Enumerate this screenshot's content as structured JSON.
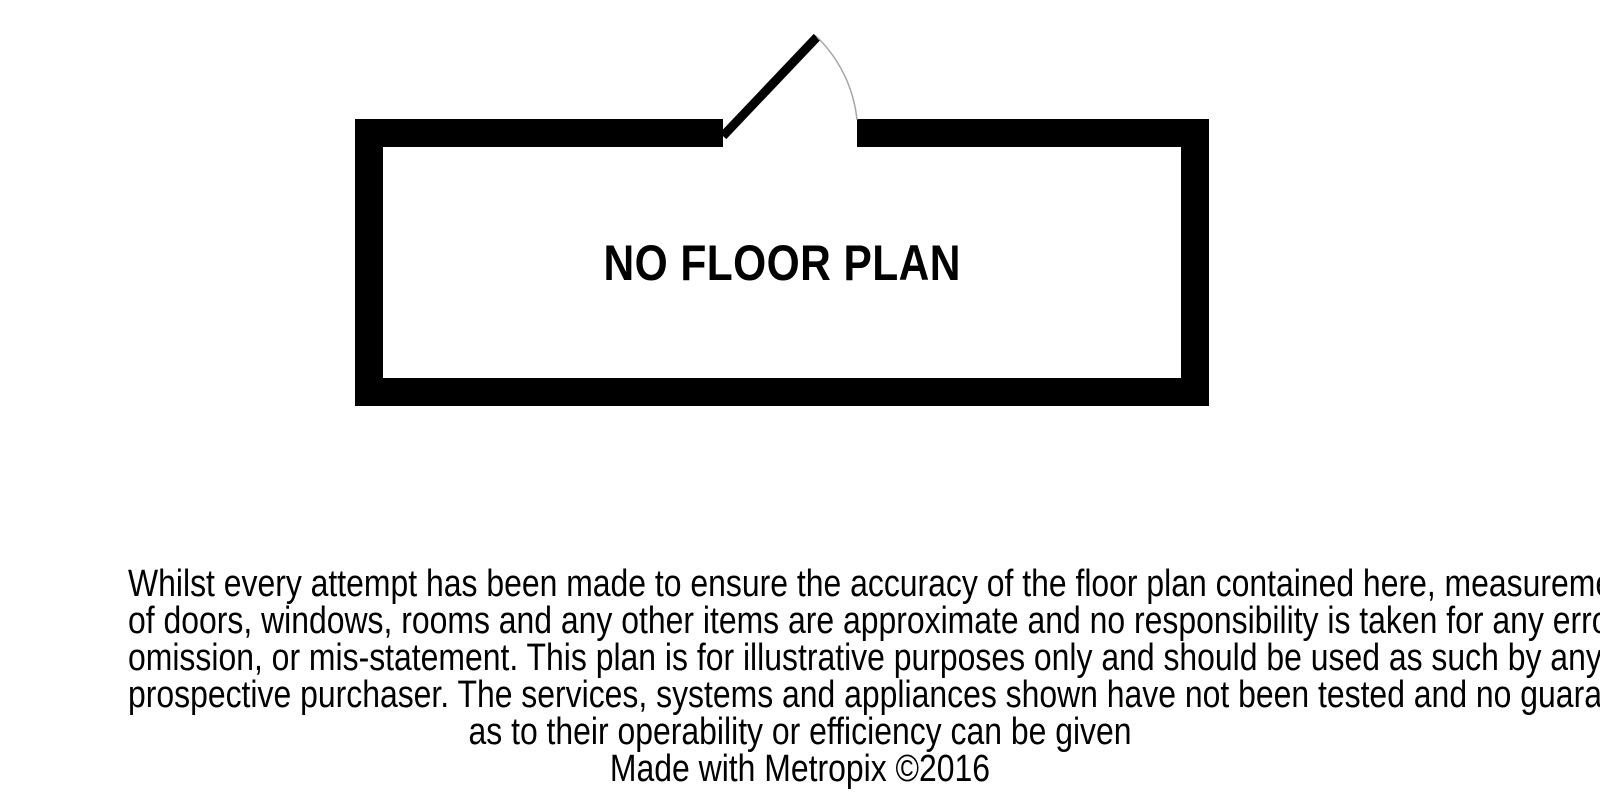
{
  "floor_plan": {
    "label": "NO FLOOR PLAN"
  },
  "disclaimer": {
    "lines": [
      "Whilst every attempt has been made to ensure the accuracy of the floor plan contained here, measurements",
      "of doors, windows, rooms and any other items are approximate and no responsibility is taken for any error,",
      "omission, or mis-statement. This plan is for illustrative purposes only and should be used as such by any",
      "prospective purchaser. The services, systems and appliances shown have not been tested and no guarantee",
      "as to their operability or efficiency can be given"
    ],
    "credit": "Made with Metropix ©2016"
  },
  "colors": {
    "wall": "#000000",
    "door_leaf": "#000000",
    "door_arc": "#a6a6a6",
    "background": "#ffffff",
    "text": "#000000"
  }
}
